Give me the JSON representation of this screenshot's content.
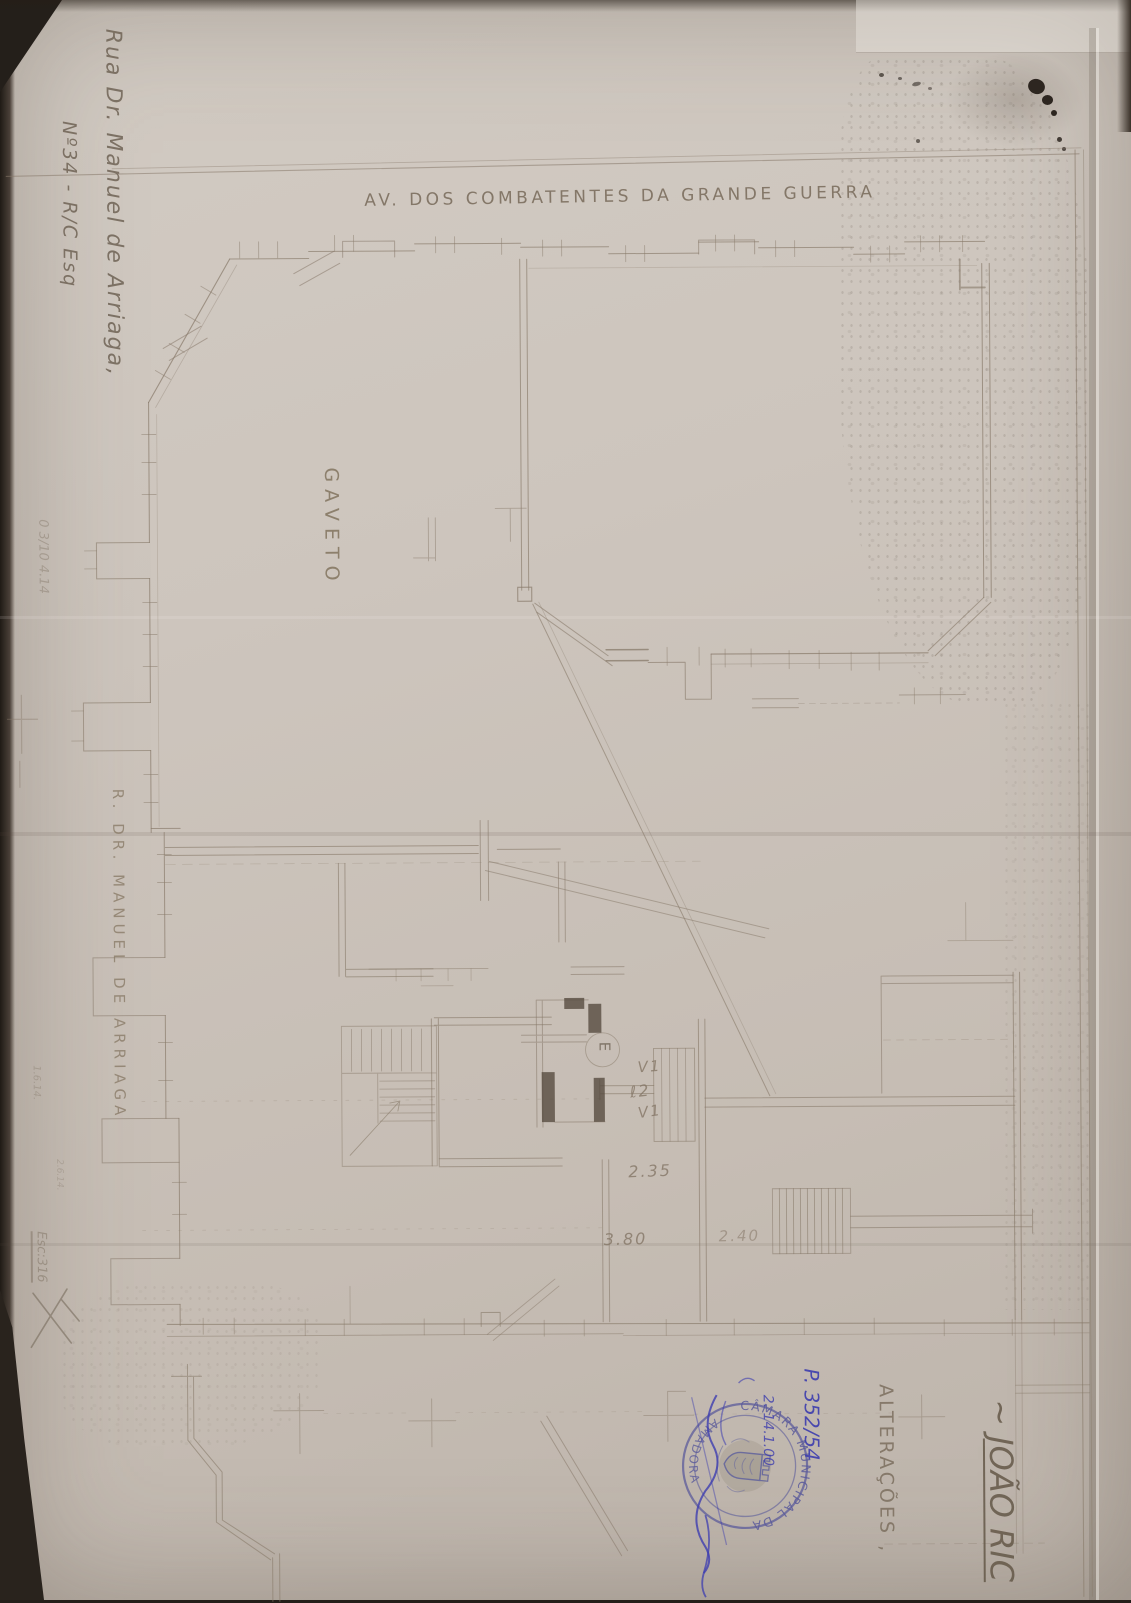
{
  "drawing": {
    "street_top_label": "AV. DOS COMBATENTES DA GRANDE GUERRA",
    "corner_label": "GAVETO",
    "street_left_label": "R. DR. MANUEL DE ARRIAGA",
    "labels": {
      "entrance": "E",
      "window_upper": "V1",
      "shaft": "ℓ2",
      "window_lower": "V1"
    },
    "dimensions": {
      "dim_a": "2.35",
      "dim_b": "3.80",
      "dim_c": "2.40"
    }
  },
  "annotations": {
    "address_line1": "Rua Dr. Manuel de Arriaga,",
    "address_line2": "Nº34 - R/C Esq",
    "owner_title_prefix": "~",
    "owner_title": "JOÃO RIC",
    "alterations": "ALTERAÇÕES ,",
    "process_number": "P. 352/54",
    "process_date": "2. 14.1.00",
    "margin_note_top": "0 3/10 4.14",
    "margin_note_a": "1.6.14.",
    "margin_note_b": "2.6.14.",
    "margin_scale": "Esc:316"
  },
  "stamp": {
    "arc_top": "CÂMARA MUNICIPAL DA",
    "arc_bottom": "AMADORA"
  }
}
